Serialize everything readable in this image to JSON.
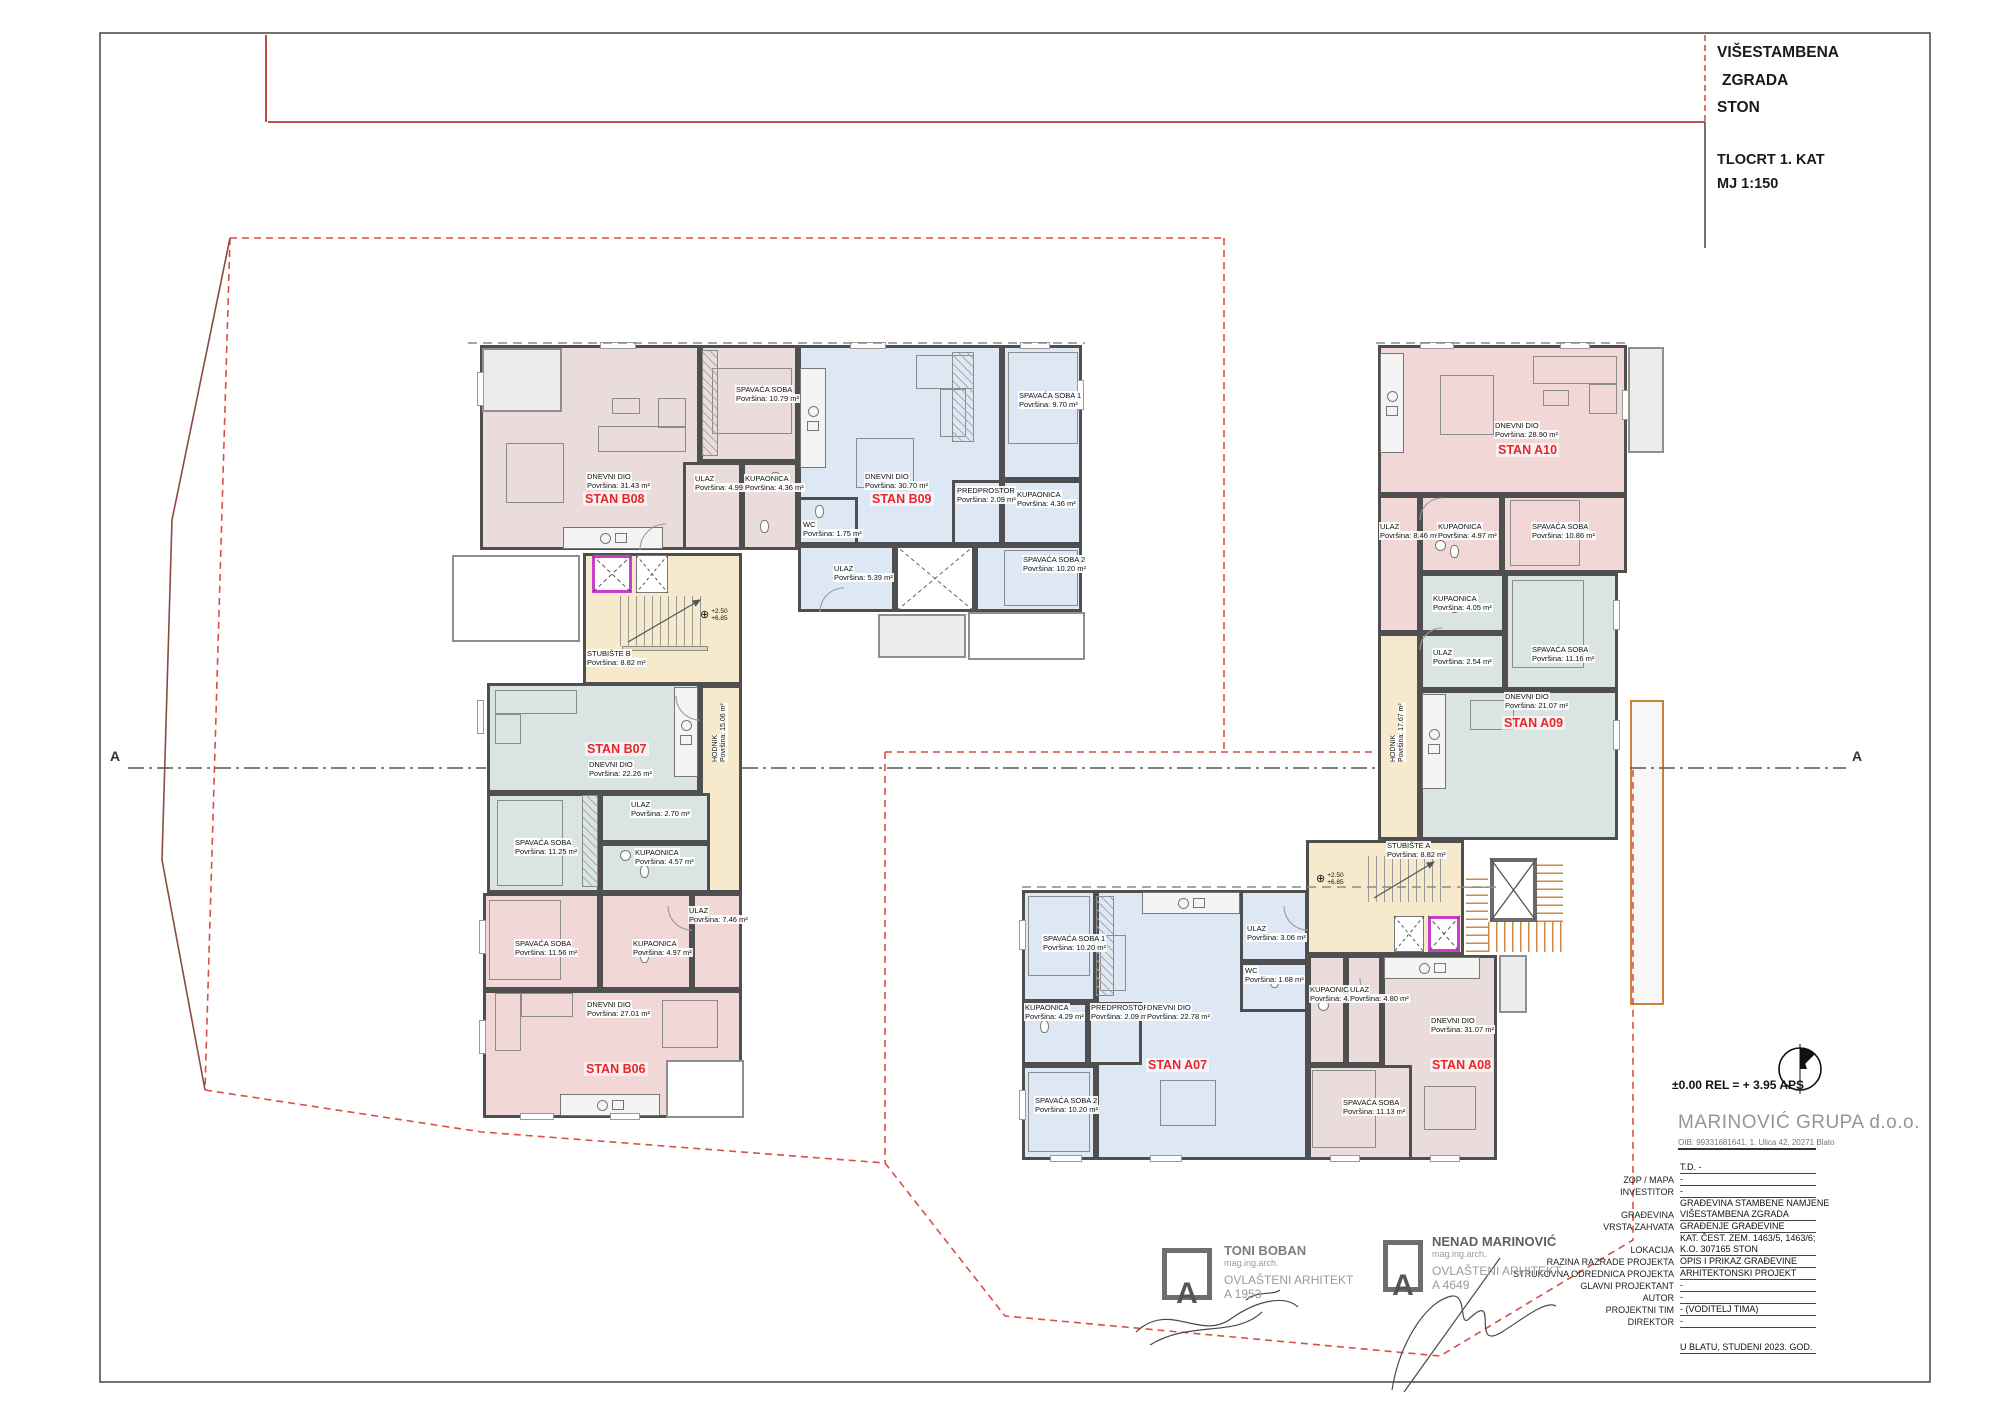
{
  "title_block": {
    "project_line1": "VIŠESTAMBENA",
    "project_line2": "ZGRADA",
    "project_line3": "STON",
    "drawing_title": "TLOCRT 1. KAT",
    "scale": "MJ 1:150"
  },
  "annotations": {
    "elevation_note": "±0.00 REL = + 3.95 APS",
    "section_marker": "A",
    "level_upper": "+2.50",
    "level_lower": "+6.85",
    "level_symbol": "⊕"
  },
  "company": {
    "name": "MARINOVIĆ GRUPA d.o.o.",
    "details": "OIB: 99331681641, 1. Ulica 42, 20271 Blato"
  },
  "info_table": {
    "rows": [
      {
        "label": "",
        "value": "T.D. -"
      },
      {
        "label": "ZOP / MAPA",
        "value": "-"
      },
      {
        "label": "INVESTITOR",
        "value": "-"
      },
      {
        "label": "GRAĐEVINA",
        "value": "GRAĐEVINA STAMBENE NAMJENE",
        "value2": "VIŠESTAMBENA ZGRADA"
      },
      {
        "label": "VRSTA ZAHVATA",
        "value": "GRAĐENJE GRAĐEVINE"
      },
      {
        "label": "LOKACIJA",
        "value": "KAT. ČEST. ZEM. 1463/5, 1463/6;",
        "value2": "K.O. 307165 STON"
      },
      {
        "label": "RAZINA RAZRADE PROJEKTA",
        "value": "OPIS I PRIKAZ GRAĐEVINE"
      },
      {
        "label": "STRUKOVNA ODREDNICA PROJEKTA",
        "value": "ARHITEKTONSKI PROJEKT"
      },
      {
        "label": "GLAVNI PROJEKTANT",
        "value": "-"
      },
      {
        "label": "AUTOR",
        "value": "-"
      },
      {
        "label": "PROJEKTNI TIM",
        "value": "- (VODITELJ TIMA)"
      },
      {
        "label": "DIREKTOR",
        "value": "-"
      }
    ],
    "date_note": "U BLATU, STUDENI 2023. GOD."
  },
  "signatures": [
    {
      "name": "TONI BOBAN",
      "degree": "mag.ing.arch.",
      "title": "OVLAŠTENI ARHITEKT",
      "number": "A 1953",
      "stamp_letter": "A"
    },
    {
      "name": "NENAD MARINOVIĆ",
      "degree": "mag.ing.arch.",
      "title": "OVLAŠTENI ARHITEKT",
      "number": "A 4649",
      "stamp_letter": "A"
    }
  ],
  "stairwells": {
    "b": {
      "name": "STUBIŠTE B",
      "area": "Površina: 8.82 m²",
      "corridor_name": "HODNIK",
      "corridor_area": "Površina: 15.06 m²"
    },
    "a": {
      "name": "STUBIŠTE A",
      "area": "Površina: 8.82 m²",
      "corridor_name": "HODNIK",
      "corridor_area": "Površina: 17.67 m²"
    }
  },
  "apartments": {
    "b08": {
      "label": "STAN B08",
      "rooms": [
        {
          "name": "DNEVNI DIO",
          "area": "Površina: 31.43 m²"
        },
        {
          "name": "SPAVAĆA SOBA",
          "area": "Površina: 10.79 m²"
        },
        {
          "name": "ULAZ",
          "area": "Površina: 4.99 m²"
        },
        {
          "name": "KUPAONICA",
          "area": "Površina: 4.36 m²"
        }
      ]
    },
    "b09": {
      "label": "STAN B09",
      "rooms": [
        {
          "name": "DNEVNI DIO",
          "area": "Površina: 30.70 m²"
        },
        {
          "name": "SPAVAĆA SOBA 1",
          "area": "Površina: 9.70 m²"
        },
        {
          "name": "PREDPROSTOR",
          "area": "Površina: 2.09 m²"
        },
        {
          "name": "KUPAONICA",
          "area": "Površina: 4.36 m²"
        },
        {
          "name": "WC",
          "area": "Površina: 1.75 m²"
        },
        {
          "name": "SPAVAĆA SOBA 2",
          "area": "Površina: 10.20 m²"
        },
        {
          "name": "ULAZ",
          "area": "Površina: 5.39 m²"
        }
      ]
    },
    "b07": {
      "label": "STAN B07",
      "rooms": [
        {
          "name": "DNEVNI DIO",
          "area": "Površina: 22.26 m²"
        },
        {
          "name": "ULAZ",
          "area": "Površina: 2.70 m²"
        },
        {
          "name": "KUPAONICA",
          "area": "Površina: 4.57 m²"
        },
        {
          "name": "SPAVAĆA SOBA",
          "area": "Površina: 11.25 m²"
        }
      ]
    },
    "b06": {
      "label": "STAN B06",
      "rooms": [
        {
          "name": "SPAVAĆA SOBA",
          "area": "Površina: 11.56 m²"
        },
        {
          "name": "KUPAONICA",
          "area": "Površina: 4.97 m²"
        },
        {
          "name": "ULAZ",
          "area": "Površina: 7.46 m²"
        },
        {
          "name": "DNEVNI DIO",
          "area": "Površina: 27.01 m²"
        }
      ]
    },
    "a10": {
      "label": "STAN A10",
      "rooms": [
        {
          "name": "DNEVNI DIO",
          "area": "Površina: 28.90 m²"
        },
        {
          "name": "ULAZ",
          "area": "Površina: 8.46 m²"
        },
        {
          "name": "KUPAONICA",
          "area": "Površina: 4.97 m²"
        },
        {
          "name": "SPAVAĆA SOBA",
          "area": "Površina: 10.86 m²"
        }
      ]
    },
    "a09": {
      "label": "STAN A09",
      "rooms": [
        {
          "name": "KUPAONICA",
          "area": "Površina: 4.05 m²"
        },
        {
          "name": "ULAZ",
          "area": "Površina: 2.54 m²"
        },
        {
          "name": "SPAVAĆA SOBA",
          "area": "Površina: 11.16 m²"
        },
        {
          "name": "DNEVNI DIO",
          "area": "Površina: 21.07 m²"
        }
      ]
    },
    "a07": {
      "label": "STAN A07",
      "rooms": [
        {
          "name": "SPAVAĆA SOBA 1",
          "area": "Površina: 10.20 m²"
        },
        {
          "name": "KUPAONICA",
          "area": "Površina: 4.29 m²"
        },
        {
          "name": "PREDPROSTOR",
          "area": "Površina: 2.09 m²"
        },
        {
          "name": "DNEVNI DIO",
          "area": "Površina: 22.78 m²"
        },
        {
          "name": "ULAZ",
          "area": "Površina: 3.06 m²"
        },
        {
          "name": "WC",
          "area": "Površina: 1.68 m²"
        },
        {
          "name": "SPAVAĆA SOBA 2",
          "area": "Površina: 10.20 m²"
        }
      ]
    },
    "a08": {
      "label": "STAN A08",
      "rooms": [
        {
          "name": "KUPAONICA",
          "area": "Površina: 4.55 m²"
        },
        {
          "name": "ULAZ",
          "area": "Površina: 4.80 m²"
        },
        {
          "name": "DNEVNI DIO",
          "area": "Površina: 31.07 m²"
        },
        {
          "name": "SPAVAĆA SOBA",
          "area": "Površina: 11.13 m²"
        }
      ]
    }
  },
  "colors": {
    "wall": "#4f4f4f",
    "apartment_label": "#e8252a",
    "boundary_red": "#d84f47",
    "stair_fill": "#f6e9cc",
    "elevator_frame": "#c93ecb",
    "external_stair": "#cb833a",
    "room_pink": "#f2d7d7",
    "room_dusty": "#e9dcda",
    "room_blue": "#dde8f4",
    "room_teal": "#d9e4e3"
  }
}
